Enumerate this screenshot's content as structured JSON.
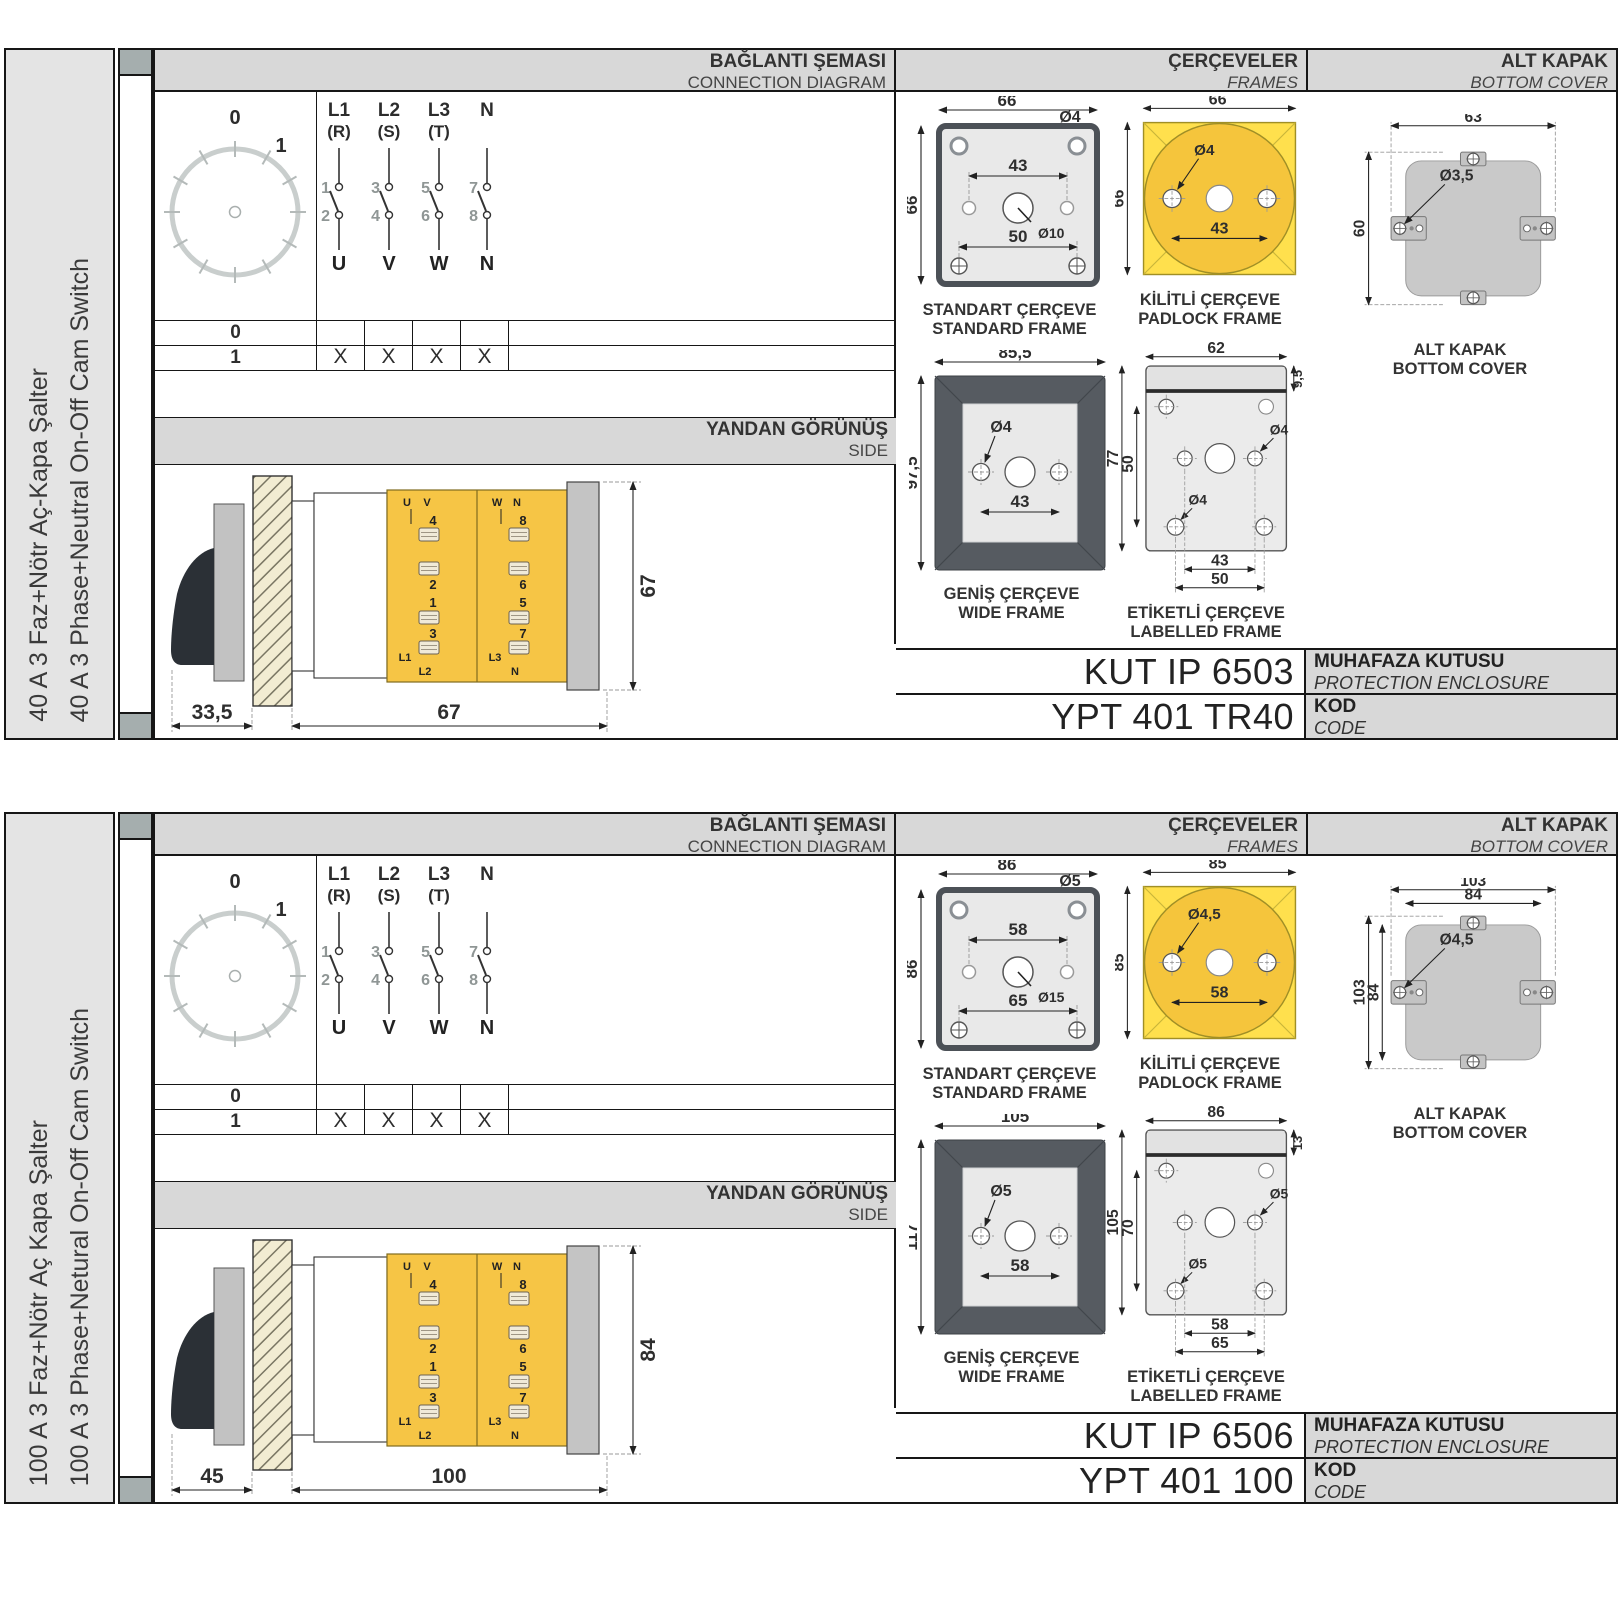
{
  "headers": {
    "connection_tr": "BAĞLANTI ŞEMASI",
    "connection_en": "CONNECTION DIAGRAM",
    "frames_tr": "ÇERÇEVELER",
    "frames_en": "FRAMES",
    "cover_tr": "ALT KAPAK",
    "cover_en": "BOTTOM COVER",
    "side_tr": "YANDAN GÖRÜNÜŞ",
    "side_en": "SIDE",
    "enclosure_tr": "MUHAFAZA KUTUSU",
    "enclosure_en": "PROTECTION ENCLOSURE",
    "code_tr": "KOD",
    "code_en": "CODE"
  },
  "connection": {
    "dial_zero": "0",
    "dial_one": "1",
    "columns": [
      {
        "line_top": "L1",
        "line_sub": "(R)",
        "num_in": "1",
        "num_out": "2",
        "terminal": "U"
      },
      {
        "line_top": "L2",
        "line_sub": "(S)",
        "num_in": "3",
        "num_out": "4",
        "terminal": "V"
      },
      {
        "line_top": "L3",
        "line_sub": "(T)",
        "num_in": "5",
        "num_out": "6",
        "terminal": "W"
      },
      {
        "line_top": "N",
        "line_sub": "",
        "num_in": "7",
        "num_out": "8",
        "terminal": "N"
      }
    ],
    "table": {
      "row0_label": "0",
      "row1_label": "1",
      "marks": [
        "X",
        "X",
        "X",
        "X"
      ]
    }
  },
  "side_view_terminals": {
    "left": [
      "U",
      "V",
      "4",
      "2",
      "1",
      "3",
      "L1",
      "L2"
    ],
    "right": [
      "W",
      "N",
      "8",
      "6",
      "5",
      "7",
      "L3",
      "N"
    ]
  },
  "frame_labels": {
    "standard_tr": "STANDART ÇERÇEVE",
    "standard_en": "STANDARD FRAME",
    "padlock_tr": "KİLİTLİ ÇERÇEVE",
    "padlock_en": "PADLOCK FRAME",
    "wide_tr": "GENİŞ ÇERÇEVE",
    "wide_en": "WIDE FRAME",
    "labelled_tr": "ETİKETLİ ÇERÇEVE",
    "labelled_en": "LABELLED FRAME",
    "cover_tr": "ALT KAPAK",
    "cover_en": "BOTTOM COVER"
  },
  "rows": [
    {
      "name_tr": "40 A 3 Faz+Nötr Aç-Kapa Şalter",
      "name_en": "40 A 3 Phase+Neutral On-Off Cam Switch",
      "side_dims": {
        "depth": "33,5",
        "width": "67",
        "height": "67"
      },
      "standard": {
        "w": "66",
        "h": "66",
        "corner_hole": "Ø4",
        "hole_span": "43",
        "center_hole": "Ø10",
        "screw_span": "50"
      },
      "padlock": {
        "w": "66",
        "h": "66",
        "hole": "Ø4",
        "hole_span": "43"
      },
      "wide": {
        "w": "85,5",
        "h": "97,5",
        "hole": "Ø4",
        "hole_span": "43"
      },
      "labelled": {
        "w": "62",
        "strip": "9,5",
        "h": "77",
        "inner_h": "50",
        "hole_a": "Ø4",
        "hole_b": "Ø4",
        "span_a": "43",
        "span_b": "50"
      },
      "cover": {
        "top_outer": "63",
        "top_inner": "",
        "left_outer": "60",
        "left_inner": "",
        "hole": "Ø3,5"
      },
      "enclosure_code": "KUT IP 6503",
      "product_code": "YPT 401 TR40"
    },
    {
      "name_tr": "100 A 3 Faz+Nötr Aç Kapa Şalter",
      "name_en": "100 A 3 Phase+Netural On-Off Cam Switch",
      "side_dims": {
        "depth": "45",
        "width": "100",
        "height": "84"
      },
      "standard": {
        "w": "86",
        "h": "86",
        "corner_hole": "Ø5",
        "hole_span": "58",
        "center_hole": "Ø15",
        "screw_span": "65"
      },
      "padlock": {
        "w": "85",
        "h": "85",
        "hole": "Ø4,5",
        "hole_span": "58"
      },
      "wide": {
        "w": "105",
        "h": "117",
        "hole": "Ø5",
        "hole_span": "58"
      },
      "labelled": {
        "w": "86",
        "strip": "13",
        "h": "105",
        "inner_h": "70",
        "hole_a": "Ø5",
        "hole_b": "Ø5",
        "span_a": "58",
        "span_b": "65"
      },
      "cover": {
        "top_outer": "103",
        "top_inner": "84",
        "left_outer": "103",
        "left_inner": "84",
        "hole": "Ø4,5"
      },
      "enclosure_code": "KUT IP 6506",
      "product_code": "YPT 401 100"
    }
  ]
}
